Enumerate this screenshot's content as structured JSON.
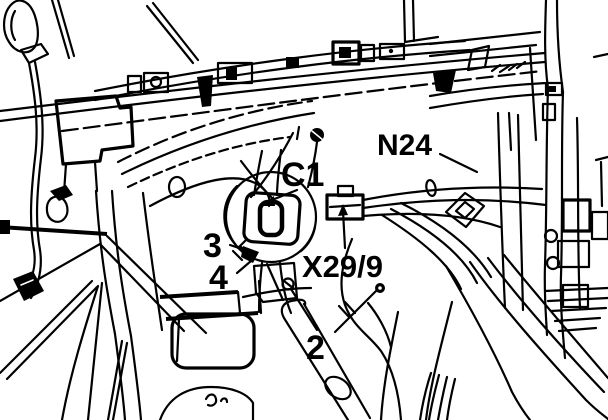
{
  "figure": {
    "kind": "service-manual line illustration",
    "background_color": "#ffffff",
    "line_color": "#000000",
    "callouts": [
      {
        "id": "c1",
        "text": "C1"
      },
      {
        "id": "n24",
        "text": "N24"
      },
      {
        "id": "pos3",
        "text": "3"
      },
      {
        "id": "pos4",
        "text": "4"
      },
      {
        "id": "x299",
        "text": "X29/9"
      },
      {
        "id": "pos2",
        "text": "2"
      }
    ]
  }
}
